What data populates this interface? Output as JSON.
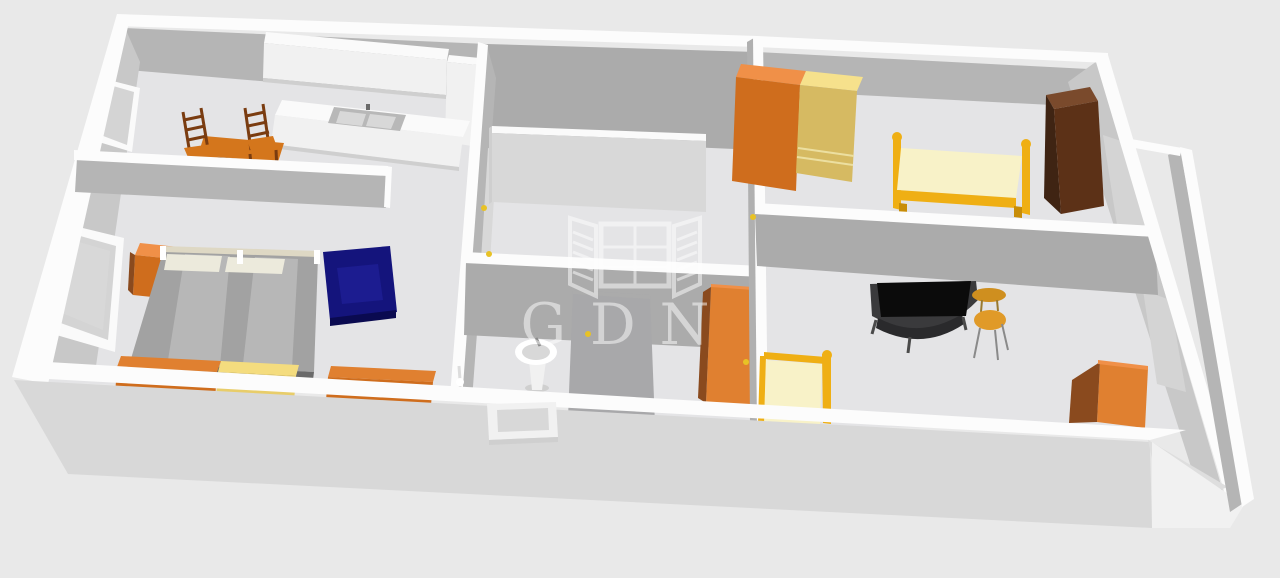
{
  "page": {
    "title": "3D apartment floor plan render",
    "background": "#e9e9e9"
  },
  "watermark": {
    "text": "GDN",
    "logo": "open-window-shutters-icon",
    "color": "#ffffff",
    "opacity": 0.5
  },
  "colors": {
    "bg": "#e9e9e9",
    "wall-top": "#fcfcfc",
    "face-a": "#c8c8c8",
    "face-b": "#b5b5b5",
    "face-c": "#ababab",
    "face-d": "#b0b0b0",
    "floor": "#e4e4e6",
    "floor-out": "#dedede",
    "front-wall": "#d8d8d8",
    "panel-light": "#d8d8d8",
    "win-inset": "#d4d4d4",
    "white-soft": "#f1f1f1",
    "white-top": "#fafafa",
    "shadow-line": "#cfcfcf",
    "orange": "#e08030",
    "orange-front": "#cf6d1d",
    "orange-deep": "#8a4a1e",
    "orange-top": "#f09048",
    "wood": "#7a3c10",
    "table-orange": "#d4761c",
    "table-front": "#a85a10",
    "yellow-top": "#f4dc7e",
    "yellow-front": "#e8cd6a",
    "wy-top": "#f6e18c",
    "wy-front": "#d6ba62",
    "gold": "#efaf14",
    "gold-dark": "#c88d08",
    "cream": "#f8f2c8",
    "navy": "#14147c",
    "navy-light": "#1c1c90",
    "navy-dark": "#0a0a50",
    "brown-top": "#7a4a2c",
    "brown-left": "#3f2413",
    "brown-right": "#5c3117",
    "bed-gray": "#a2a2a2",
    "bed-gray-light": "#b7b7b7",
    "bed-edge": "#6a6a6a",
    "pillow": "#eceadc",
    "headboard": "#ded8c4",
    "black": "#0b0b0b",
    "desk": "#3a3a3c",
    "chair-orange": "#e09a28",
    "side-table": "#cf8f1f",
    "sink-gray": "#b8b8b8",
    "basin": "#d8d8d8",
    "handle": "#e8c225",
    "white": "#ffffff",
    "shower": "#a8a8aa"
  },
  "scene": {
    "type": "3d-floorplan-perspective",
    "rooms": [
      {
        "name": "kitchen-dining",
        "furniture": [
          "wall-cabinets",
          "kitchen-counter",
          "double-sink",
          "tall-cabinet",
          "dining-table",
          "wooden-chair",
          "wooden-chair"
        ],
        "window": true
      },
      {
        "name": "bedroom",
        "furniture": [
          "nightstand",
          "double-bed",
          "pillows",
          "navy-armchair",
          "orange-dresser",
          "yellow-dresser",
          "orange-dresser"
        ],
        "window": true
      },
      {
        "name": "hall",
        "furniture": [
          "partition-wall"
        ],
        "window": false
      },
      {
        "name": "bathroom",
        "furniture": [
          "shower-stall",
          "pedestal-sink",
          "toilet-brush",
          "orange-tall-cabinet"
        ],
        "window": false
      },
      {
        "name": "bedroom-2",
        "furniture": [
          "orange-wardrobe",
          "yellow-wardrobe",
          "gold-single-bed",
          "brown-wardrobe"
        ],
        "window": true
      },
      {
        "name": "living-room",
        "furniture": [
          "desk",
          "monitor",
          "office-chair",
          "side-table",
          "gold-single-bed-small",
          "orange-cabinet"
        ],
        "window": true
      },
      {
        "name": "balcony",
        "furniture": [],
        "window": false
      }
    ]
  }
}
